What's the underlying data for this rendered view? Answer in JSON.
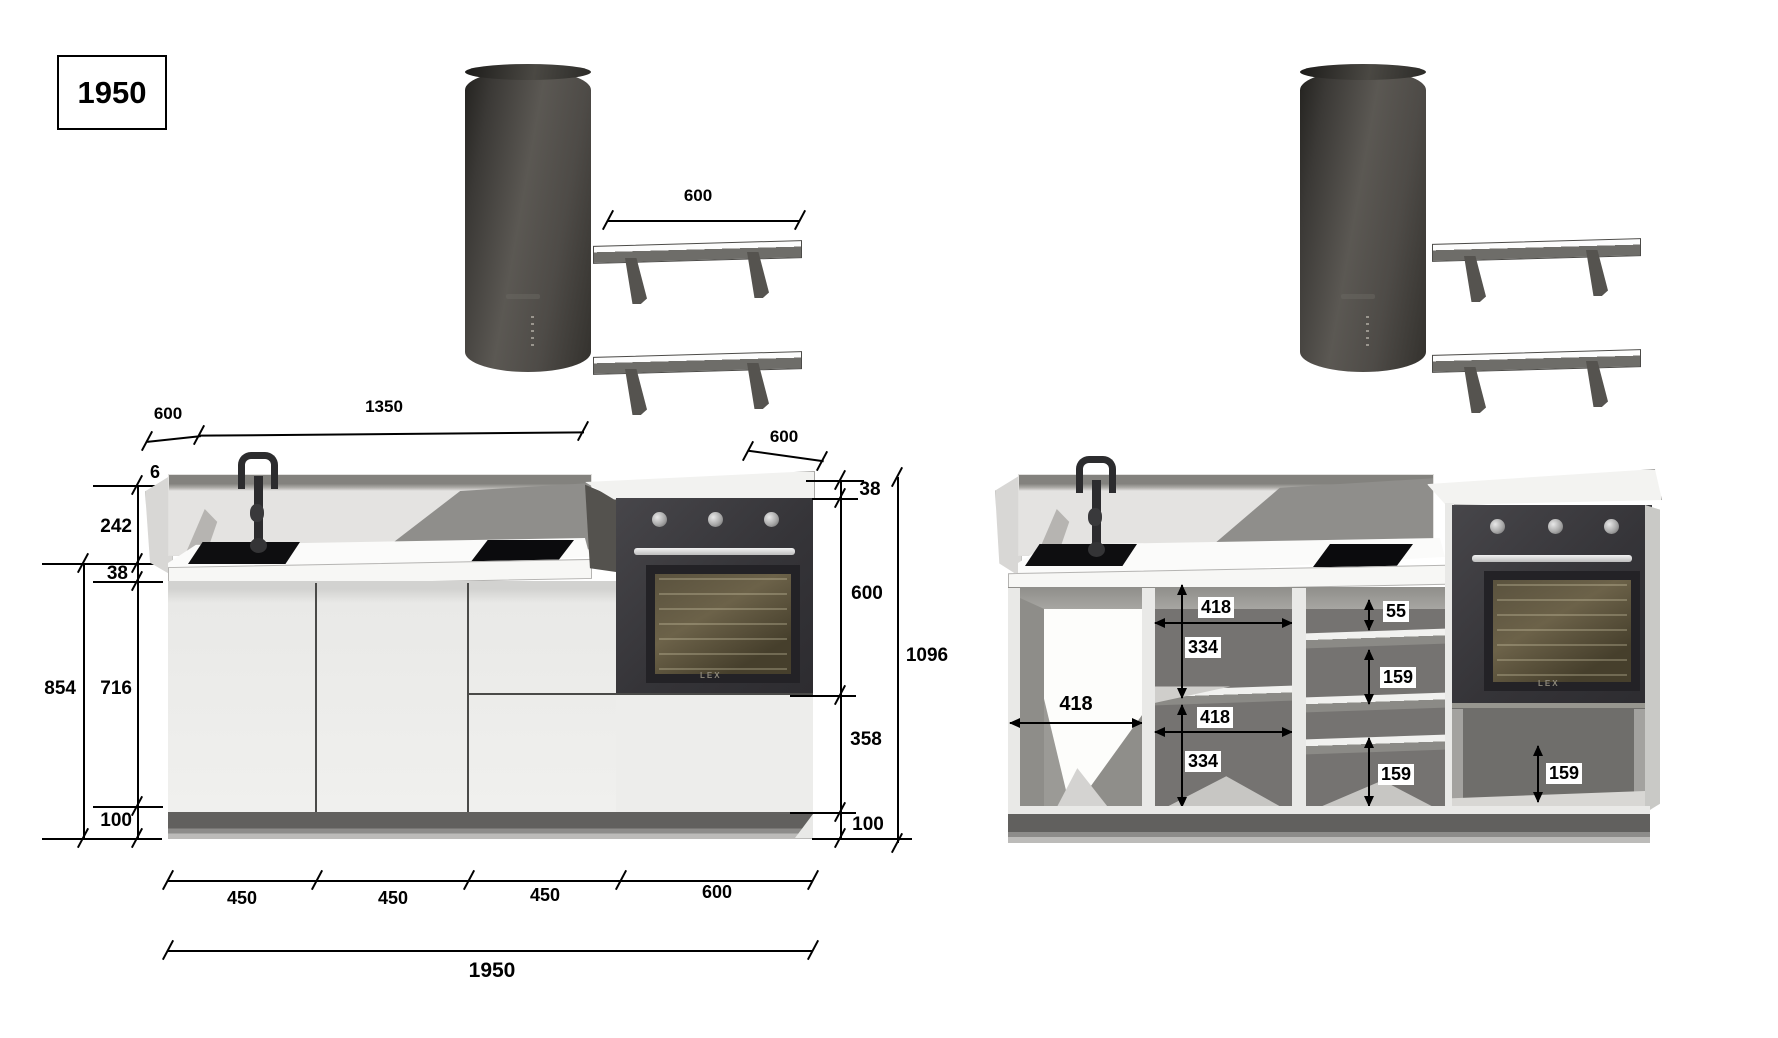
{
  "title": "1950",
  "colors": {
    "line": "#000000",
    "cabinet_face": "#efefed",
    "backsplash": "#e4e3e1",
    "interior_gray": "#757371",
    "oven_black": "#353438",
    "hood_gray": "#4e4b47",
    "plinth_gray": "#61605e"
  },
  "left_view": {
    "hood": "cooker-hood-cylinder",
    "shelf_dim": "600",
    "top_dims": {
      "left_depth": "600",
      "run_width": "1350"
    },
    "left_dims": {
      "splash_thickness": "6",
      "splash_depth": "594",
      "splash_height": "242",
      "worktop_thickness": "38",
      "base_total_height": "854",
      "carcass_height": "716",
      "plinth_height": "100"
    },
    "bottom": [
      "450",
      "450",
      "450",
      "600"
    ],
    "total_width": "1950",
    "right_dims": {
      "oven_unit_depth": "600",
      "worktop_thickness": "38",
      "oven_height": "600",
      "tall_unit_height": "1096",
      "under_oven_height": "358",
      "plinth_height": "100"
    },
    "oven_logo": "LEX"
  },
  "right_view": {
    "dims": {
      "open_section_width": "418",
      "mid_shelf_width_top": "418",
      "mid_height_top": "334",
      "mid_shelf_width_bottom": "418",
      "mid_height_bottom": "334",
      "drawer_slot_top": "55",
      "drawer_slot_middle": "159",
      "drawer_slot_bottom": "159",
      "under_oven_drawer": "159"
    },
    "oven_logo": "LEX"
  }
}
